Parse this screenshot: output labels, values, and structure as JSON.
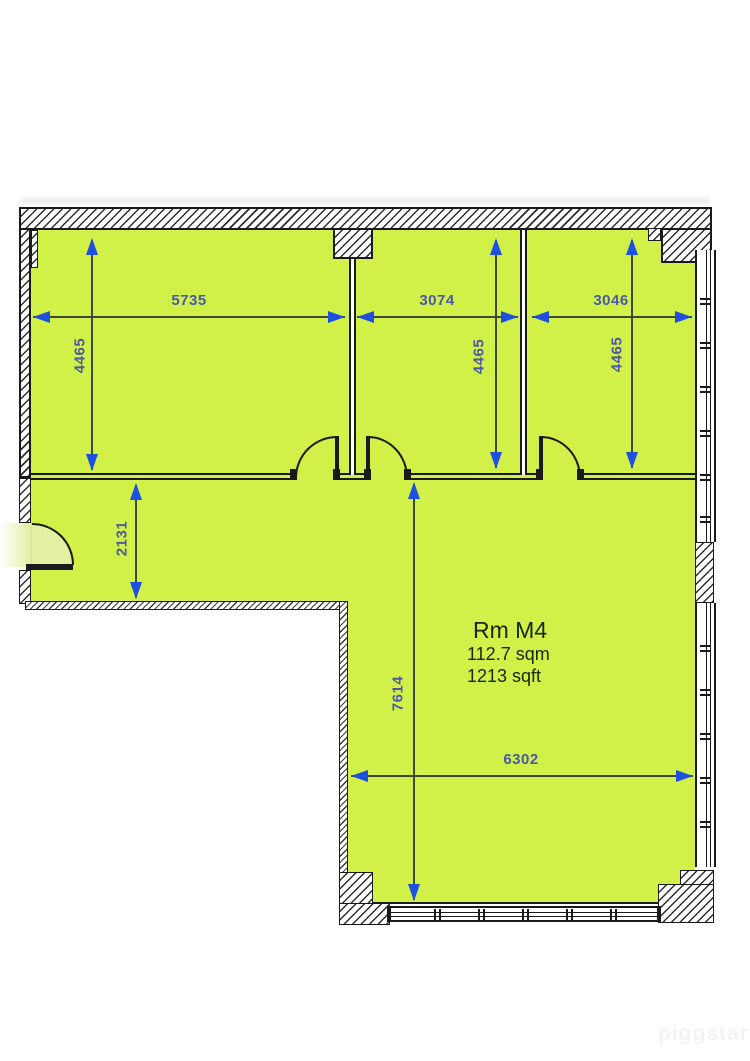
{
  "plan": {
    "room": {
      "name": "Rm M4",
      "area_sqm": "112.7 sqm",
      "area_sqft": "1213 sqft"
    },
    "dimensions": {
      "top_left_width": "5735",
      "top_mid_width": "3074",
      "top_right_width": "3046",
      "left_room_depth": "4465",
      "mid_room_depth": "4465",
      "right_room_depth": "4465",
      "corridor_depth": "2131",
      "main_room_depth": "7614",
      "main_room_width": "6302"
    },
    "watermark": "piggstar",
    "colors": {
      "room_fill": "#d2f148",
      "door_swing_fill": "#e3f0a2",
      "dimension_arrow": "#1d4fe0",
      "dimension_text": "#4b58a5",
      "wall_line": "#1a1a1a"
    }
  }
}
